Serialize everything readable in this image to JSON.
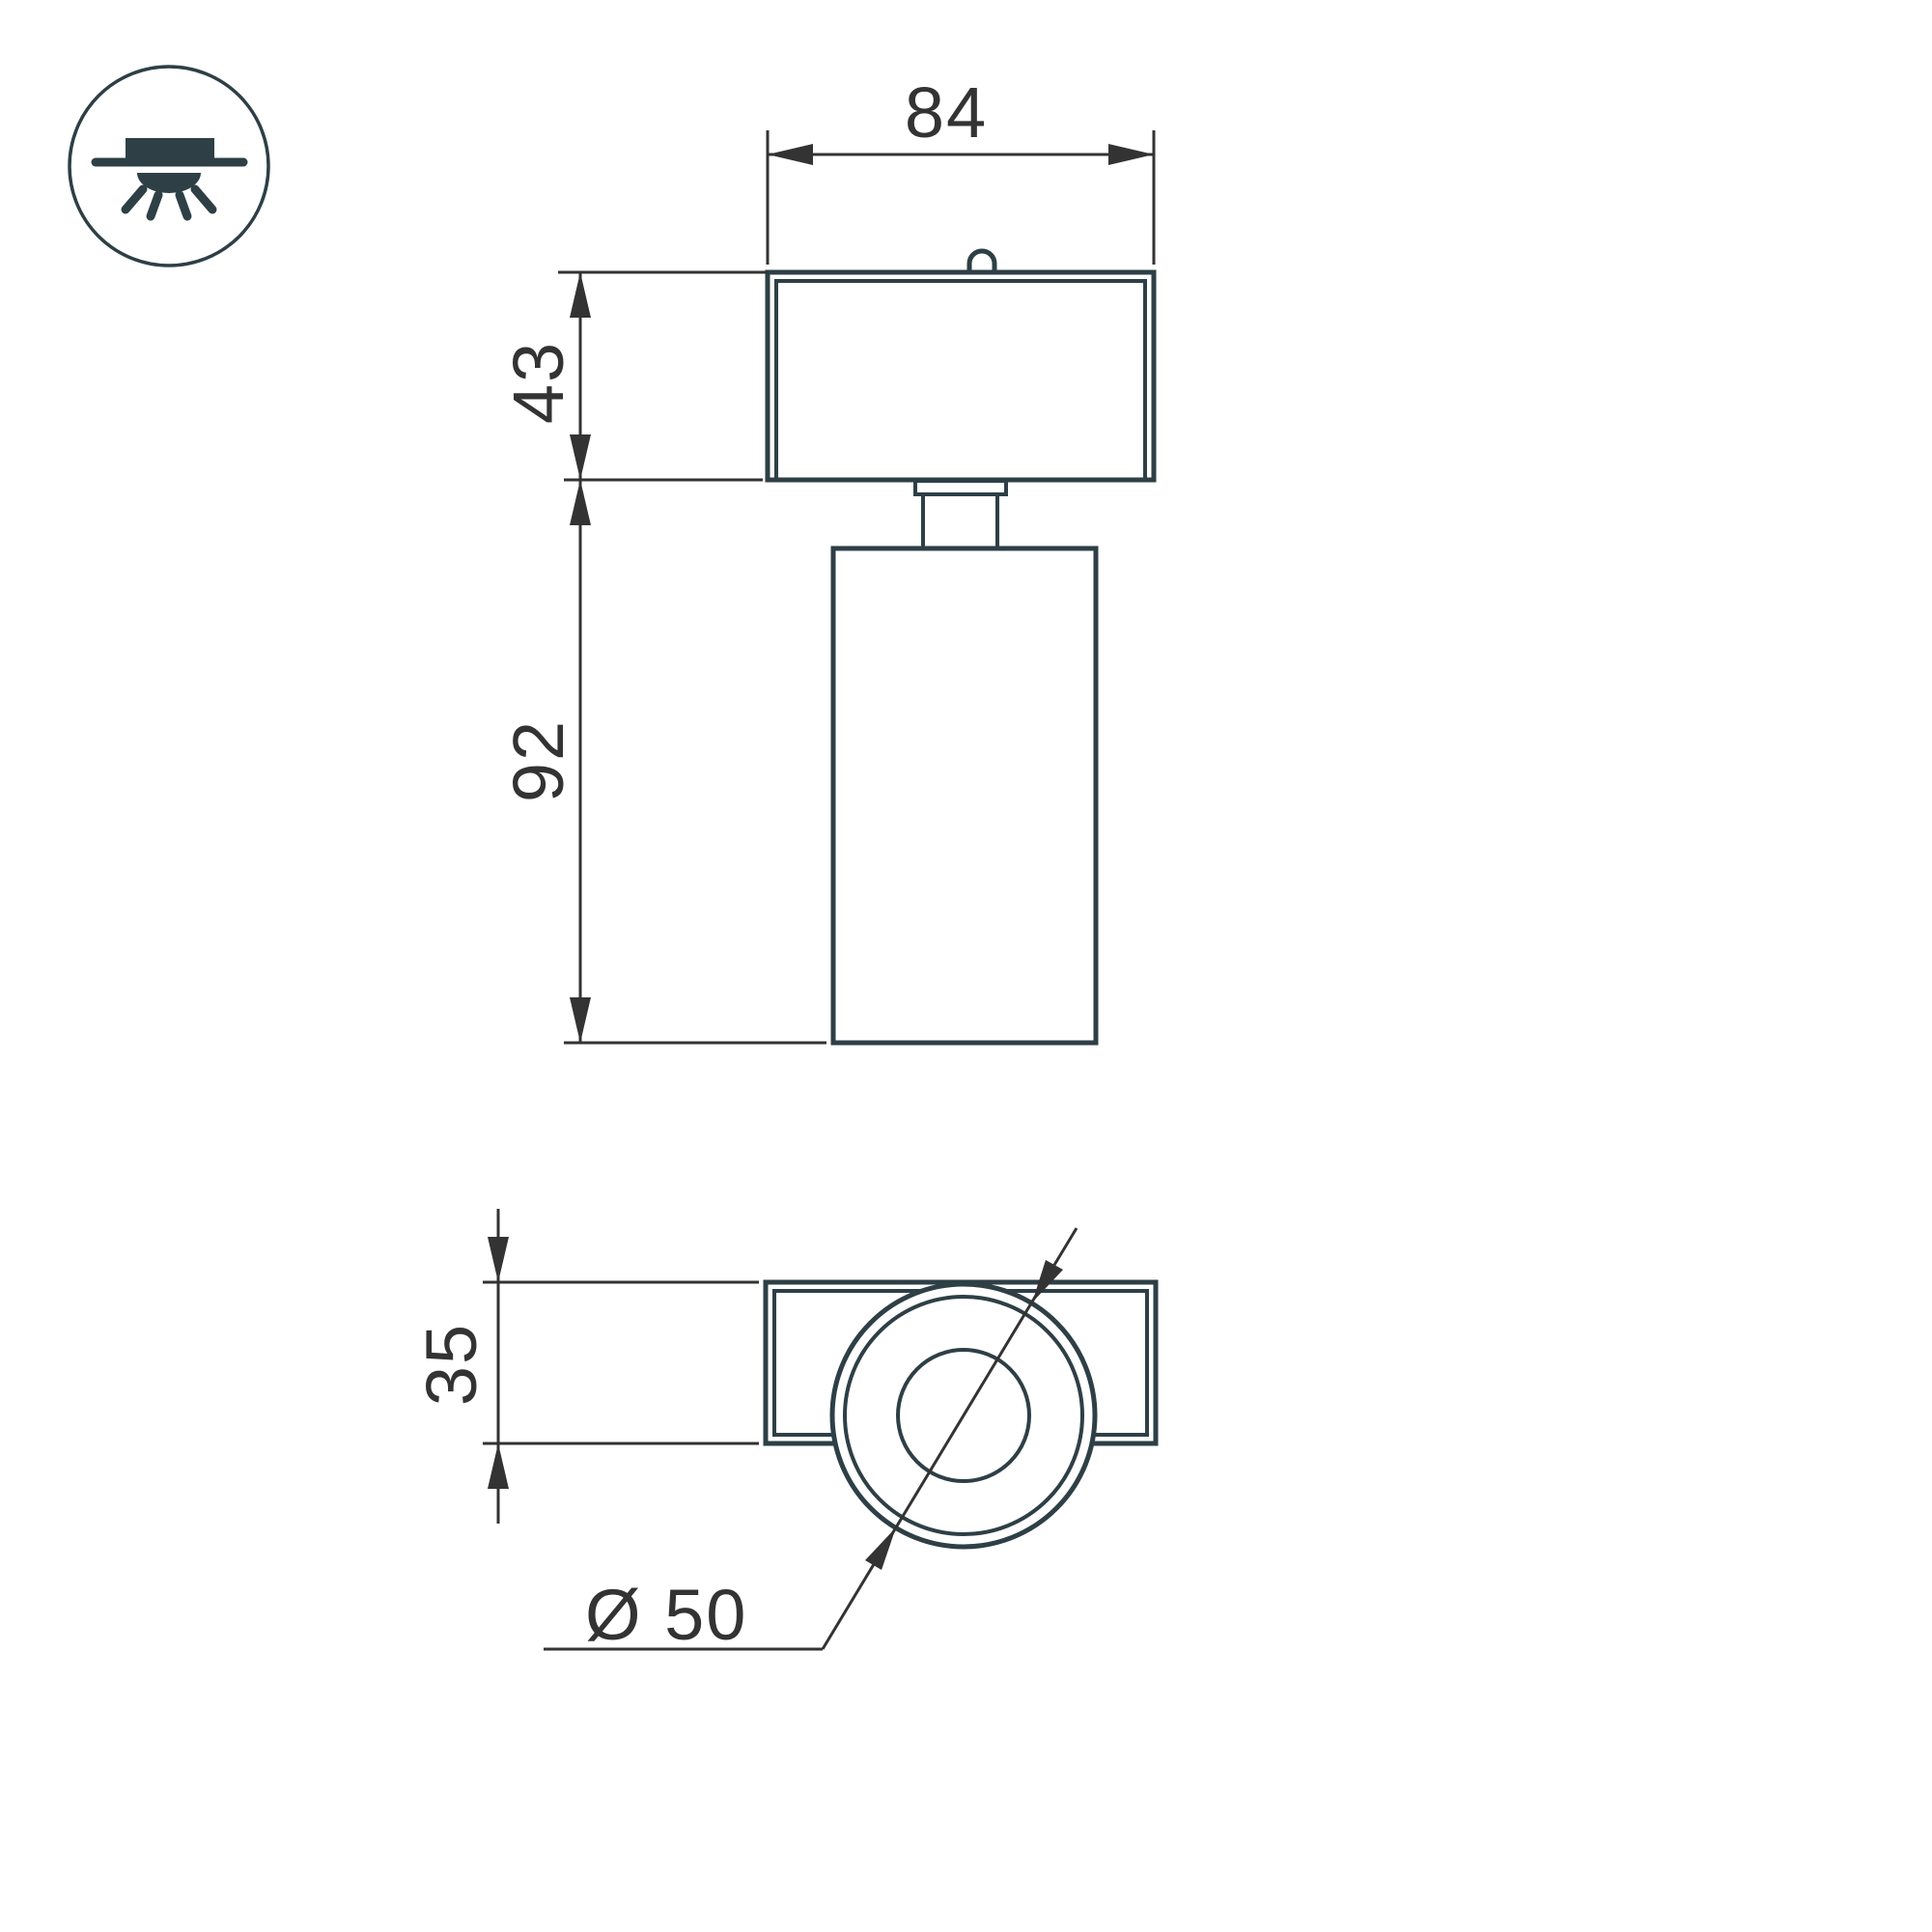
{
  "document": {
    "type": "technical-dimension-drawing",
    "subject": "surface-mounted spot luminaire, front view and bottom view"
  },
  "icon": {
    "name": "recessed-ceiling-light-icon"
  },
  "labels": {
    "top_width": "84",
    "base_height": "43",
    "body_height": "92",
    "plate_height": "35",
    "head_diameter": "Ø 50"
  },
  "colors": {
    "object_line": "#2e3f46",
    "dimension_line": "#333333",
    "background": "#ffffff"
  }
}
